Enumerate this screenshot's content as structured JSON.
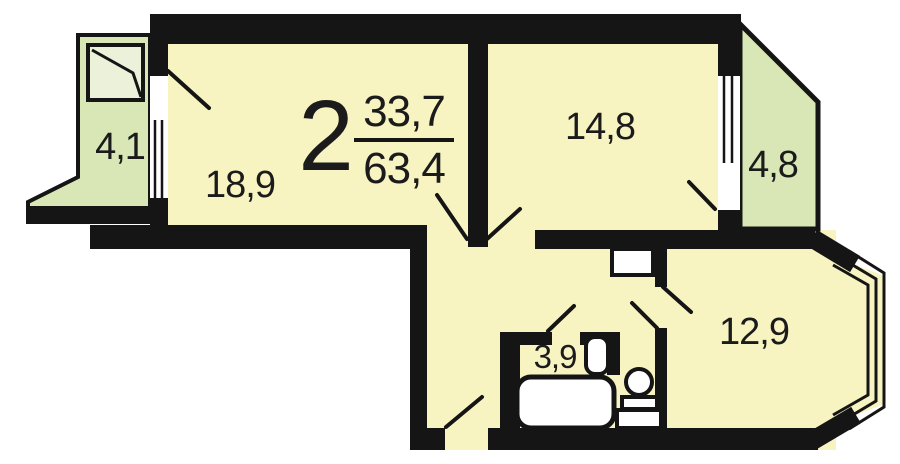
{
  "title": "2-room apartment floor plan",
  "apartment": {
    "rooms_count": "2",
    "living_area": "33,7",
    "total_area": "63,4"
  },
  "rooms": {
    "living_room_left": {
      "name": "living room",
      "area": "18,9"
    },
    "living_room_right": {
      "name": "bedroom",
      "area": "14,8"
    },
    "kitchen": {
      "name": "kitchen",
      "area": "12,9"
    },
    "bathroom": {
      "name": "bathroom",
      "area": "3,9"
    },
    "balcony_left": {
      "name": "balcony",
      "area": "4,1"
    },
    "balcony_right": {
      "name": "balcony",
      "area": "4,8"
    }
  },
  "fixtures": [
    "bathtub",
    "sink",
    "toilet",
    "cabinet",
    "bay-window",
    "windows",
    "door-swings"
  ],
  "colors": {
    "wall": "#151515",
    "room_fill": "#f8f4c2",
    "balcony_fill": "#d9e6b6",
    "background": "#ffffff",
    "text": "#1b1b1b"
  }
}
